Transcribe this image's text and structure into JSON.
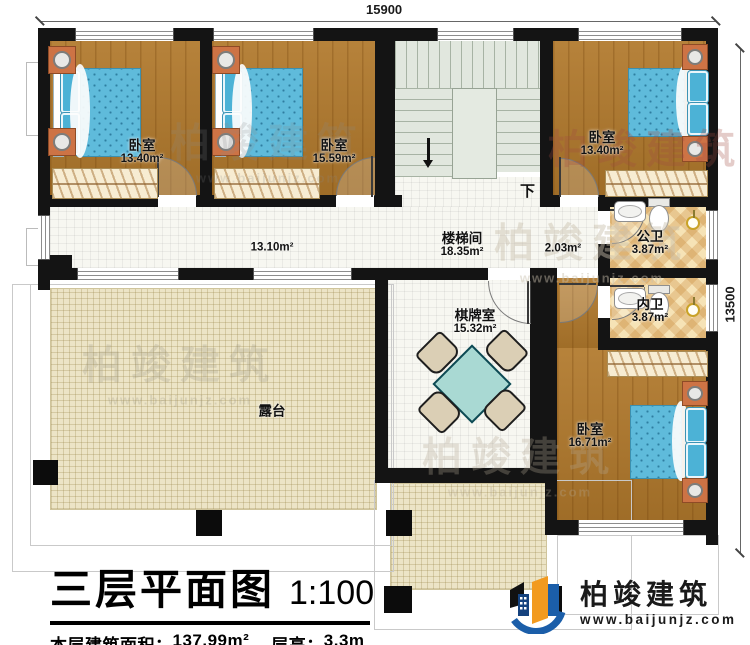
{
  "dimensions": {
    "top": "15900",
    "right": "13500"
  },
  "rooms": {
    "bedroom_tl": {
      "name": "卧室",
      "area": "13.40m²"
    },
    "bedroom_tm": {
      "name": "卧室",
      "area": "15.59m²"
    },
    "bedroom_tr": {
      "name": "卧室",
      "area": "13.40m²"
    },
    "bedroom_br": {
      "name": "卧室",
      "area": "16.71m²"
    },
    "stairwell": {
      "name": "楼梯间",
      "area": "18.35m²"
    },
    "corridor": {
      "area": "13.10m²"
    },
    "hall": {
      "area": "2.03m²"
    },
    "public_bath": {
      "name": "公卫",
      "area": "3.87m²"
    },
    "inner_bath": {
      "name": "内卫",
      "area": "3.87m²"
    },
    "game_room": {
      "name": "棋牌室",
      "area": "15.32m²"
    },
    "terrace": {
      "name": "露台"
    }
  },
  "stair": {
    "down_label": "下"
  },
  "title_block": {
    "title": "三层平面图",
    "scale": "1:100",
    "floor_area_label": "本层建筑面积：",
    "floor_area_value": "137.99m²",
    "height_label": "层高：",
    "height_value": "3.3m"
  },
  "logo": {
    "company": "柏竣建筑",
    "website": "www.baijunjz.com"
  },
  "watermark": {
    "text": "柏竣建筑",
    "sub": "www.baijunjz.com"
  },
  "colors": {
    "wall": "#141414",
    "wood_floor": "#b1792c",
    "terrace_floor": "#ece4c6",
    "bath_tile": "#f6e3b6",
    "bed_blue": "#5fbbdb",
    "stair_green": "#e1e7de",
    "logo_blue": "#1b5ea9",
    "logo_orange": "#f29a1f"
  }
}
